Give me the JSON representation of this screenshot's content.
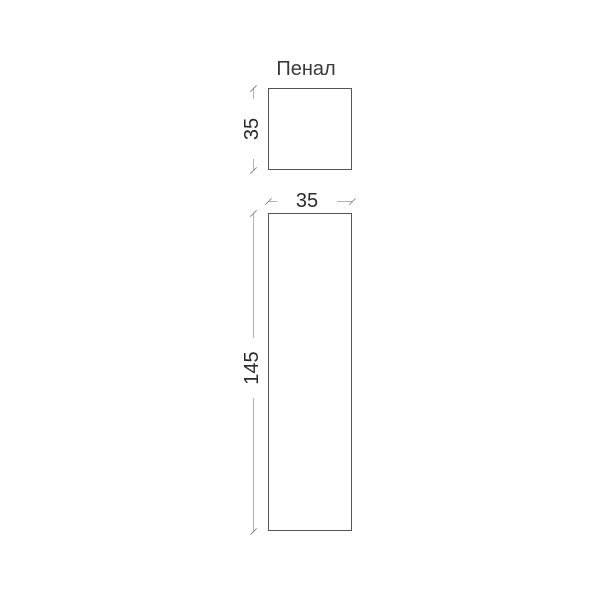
{
  "drawing": {
    "title": "Пенал",
    "dimensions": {
      "top_view_depth": "35",
      "front_view_width": "35",
      "front_view_height": "145"
    },
    "colors": {
      "background": "#ffffff",
      "shape_outline": "#555555",
      "dimension_line": "#b3b3b3",
      "dimension_tick": "#8a8a8a",
      "dimension_text": "#2b2b2b",
      "title_text": "#3a3a3a"
    }
  }
}
